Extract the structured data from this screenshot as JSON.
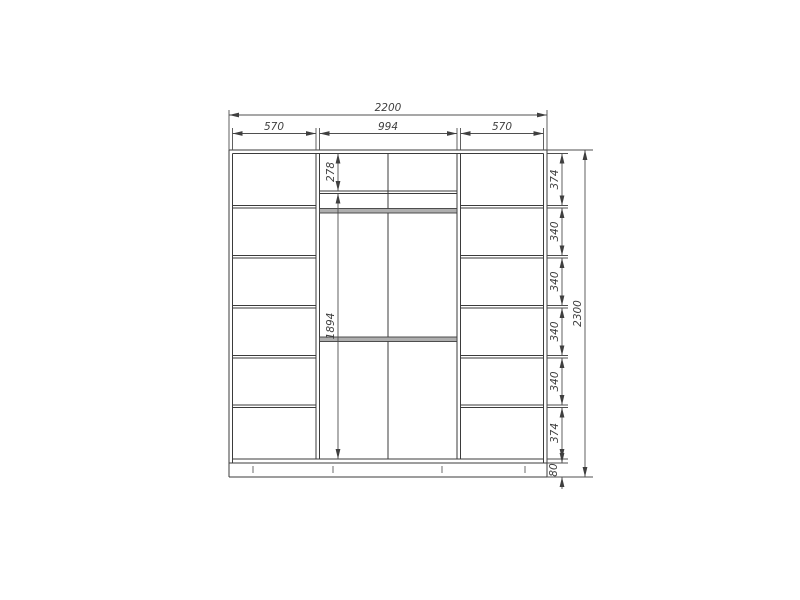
{
  "drawing": {
    "colors": {
      "line": "#3b3b3b",
      "dimension": "#4f4f4f",
      "rail_fill": "#aeaeae",
      "background": "#ffffff"
    },
    "dims": {
      "total_width": "2200",
      "left_width": "570",
      "middle_width": "994",
      "right_width": "570",
      "top_compartment": "278",
      "hanging_space": "1894",
      "right_segments": [
        "374",
        "340",
        "340",
        "340",
        "340",
        "374"
      ],
      "plinth": "80",
      "total_height": "2300"
    }
  }
}
